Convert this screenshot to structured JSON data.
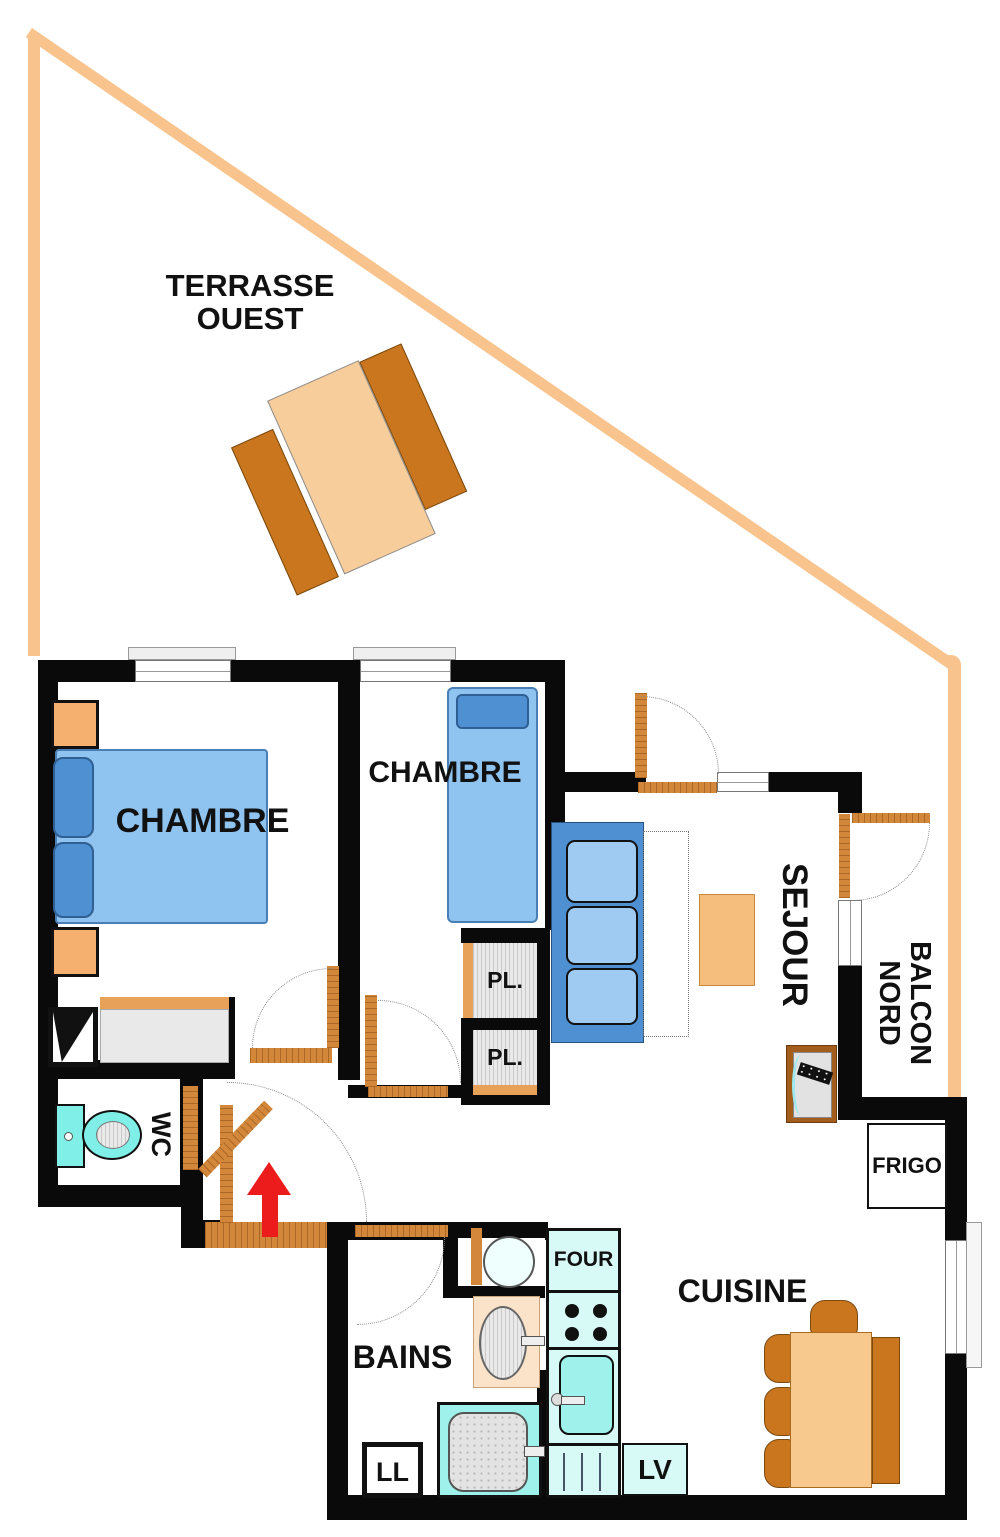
{
  "plan": {
    "labels": {
      "terrace1": "TERRASSE",
      "terrace2": "OUEST",
      "bedroom1": "CHAMBRE",
      "bedroom2": "CHAMBRE",
      "living": "SEJOUR",
      "balcony1": "BALCON",
      "balcony2": "NORD",
      "wc": "WC",
      "bath": "BAINS",
      "kitchen": "CUISINE",
      "closet1": "PL.",
      "closet2": "PL.",
      "fridge": "FRIGO",
      "oven": "FOUR",
      "washing_machine": "LL",
      "dishwasher": "LV"
    },
    "colors": {
      "wall": "#0a0a0a",
      "terrace_outline": "#f8c38d",
      "door_wood": "#d2873b",
      "wood_light": "#f8cd9c",
      "wood_dark": "#c9761f",
      "bed_light_blue": "#8fc3f0",
      "bed_dark_blue": "#4e90d2",
      "fixture_cyan": "#9ff2ec",
      "counter_cyan": "#d8faf7",
      "closet_grey": "#e9e9e9",
      "entry_arrow_red": "#ec1c1c"
    }
  }
}
